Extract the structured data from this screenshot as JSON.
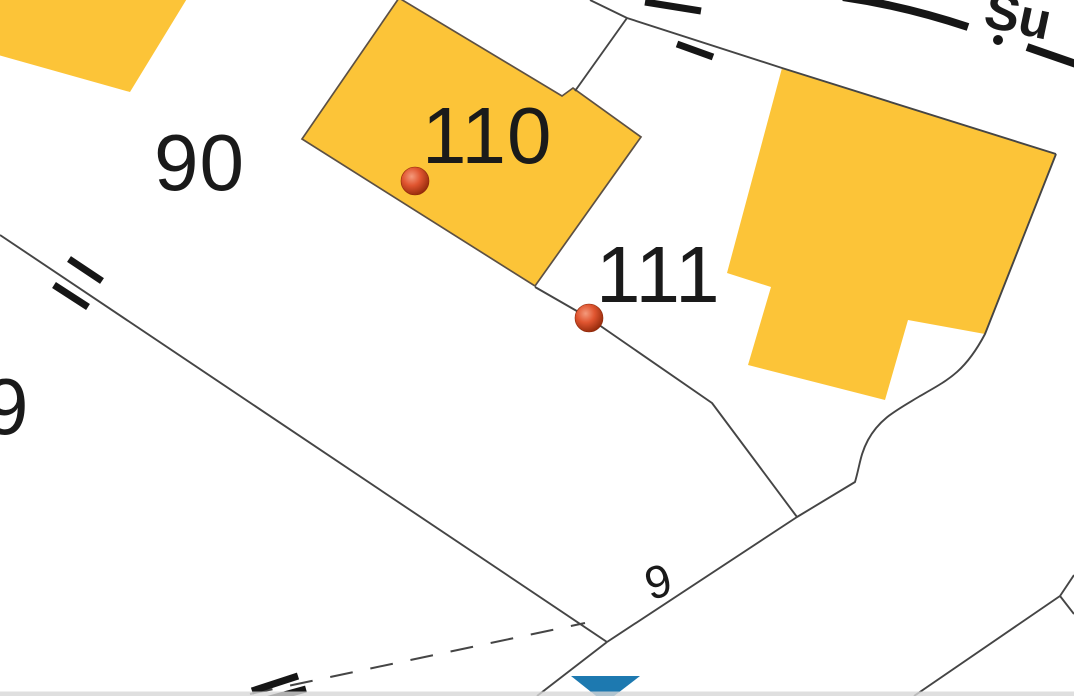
{
  "map": {
    "labels": {
      "parcel_90": "90",
      "parcel_110": "110",
      "parcel_111": "111",
      "parcel_edge_partial": "9",
      "road_number": "9",
      "street_name_partial": "Su"
    },
    "colors": {
      "background": "#ffffff",
      "building_fill": "#fcc438",
      "building_stroke": "#5c5044",
      "boundary_line": "#454545",
      "symbol_black": "#161616",
      "label_text": "#1a1a1a",
      "address_point_highlight": "#f49a7c",
      "address_point_mid": "#e05530",
      "address_point_dark": "#8e2708",
      "marker_blue": "#1d79b0",
      "bottom_bar": "#d7d7d7"
    }
  }
}
